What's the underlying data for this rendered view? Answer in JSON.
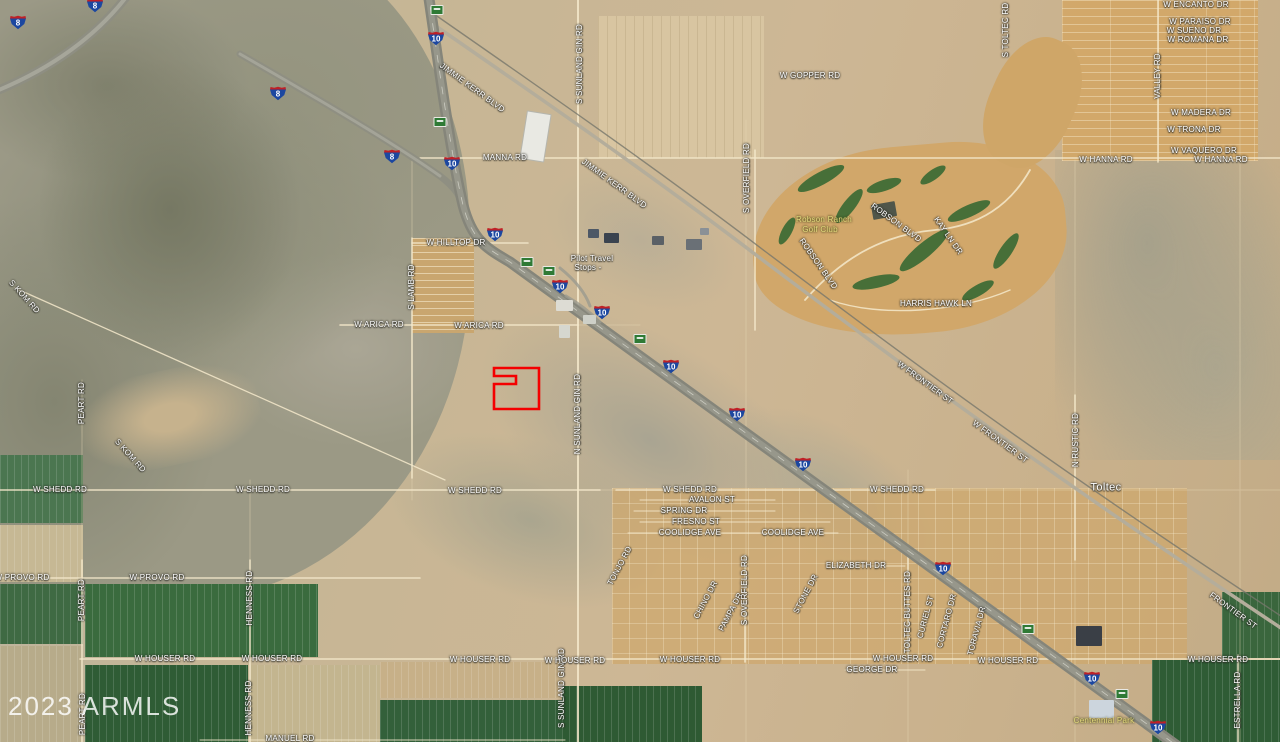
{
  "watermark": {
    "text": "2023 ARMLS"
  },
  "colors": {
    "parcel_outline": "#f40000",
    "shield_blue": "#1c47a0",
    "shield_red": "#bf2026",
    "mile_marker_green": "#2f7a35"
  },
  "map": {
    "parcel": {
      "x": 494,
      "y": 368,
      "w": 45,
      "h": 41,
      "notch_x": 516,
      "notch_y1": 376,
      "notch_y2": 384,
      "stroke": "#f40000",
      "stroke_width": 2.6
    },
    "labels": [
      {
        "t": "JIMMIE KERR BLVD",
        "x": 472,
        "y": 88,
        "r": 36
      },
      {
        "t": "JIMMIE KERR BLVD",
        "x": 614,
        "y": 184,
        "r": 36
      },
      {
        "t": "MANNA RD",
        "x": 505,
        "y": 158
      },
      {
        "t": "W GOPPER RD",
        "x": 810,
        "y": 76
      },
      {
        "t": "S TOLTEC RD",
        "x": 1006,
        "y": 30,
        "r": -90
      },
      {
        "t": "W ENCANTO DR",
        "x": 1196,
        "y": 5
      },
      {
        "t": "W PARAISO DR",
        "x": 1200,
        "y": 22
      },
      {
        "t": "W SUENO DR",
        "x": 1194,
        "y": 31
      },
      {
        "t": "W ROMANA DR",
        "x": 1198,
        "y": 40
      },
      {
        "t": "VALLEY RD",
        "x": 1158,
        "y": 76,
        "r": -90
      },
      {
        "t": "W MADERA DR",
        "x": 1201,
        "y": 113
      },
      {
        "t": "W TRONA DR",
        "x": 1194,
        "y": 130
      },
      {
        "t": "W VAQUERO DR",
        "x": 1204,
        "y": 151
      },
      {
        "t": "W HANNA RD",
        "x": 1106,
        "y": 160
      },
      {
        "t": "W HANNA RD",
        "x": 1221,
        "y": 160
      },
      {
        "t": "S SUNLAND GIN RD",
        "x": 580,
        "y": 64,
        "r": -90
      },
      {
        "t": "W HILLTOP DR",
        "x": 456,
        "y": 243
      },
      {
        "t": "S LAMB RD",
        "x": 412,
        "y": 287,
        "r": -90
      },
      {
        "t": "W ARICA RD",
        "x": 379,
        "y": 325
      },
      {
        "t": "W ARICA RD",
        "x": 479,
        "y": 326
      },
      {
        "t": "S OVERFIELD RD",
        "x": 747,
        "y": 178,
        "r": -90
      },
      {
        "t": "ROBSON BLVD",
        "x": 896,
        "y": 223,
        "r": 36
      },
      {
        "t": "ROBSON BLVD",
        "x": 818,
        "y": 264,
        "r": 55
      },
      {
        "t": "KAY LN DR",
        "x": 948,
        "y": 236,
        "r": 55
      },
      {
        "t": "HARRIS HAWK LN",
        "x": 936,
        "y": 304
      },
      {
        "t": "N SUNLAND GIN RD",
        "x": 578,
        "y": 414,
        "r": -90
      },
      {
        "t": "W FRONTIER ST",
        "x": 925,
        "y": 383,
        "r": 36
      },
      {
        "t": "W FRONTIER ST",
        "x": 1000,
        "y": 442,
        "r": 36
      },
      {
        "t": "N RUSTIC RD",
        "x": 1076,
        "y": 440,
        "r": -90
      },
      {
        "t": "S KOM RD",
        "x": 24,
        "y": 297,
        "r": 48
      },
      {
        "t": "S KOM RD",
        "x": 130,
        "y": 456,
        "r": 48
      },
      {
        "t": "PEART RD",
        "x": 82,
        "y": 403,
        "r": -90
      },
      {
        "t": "W SHEDD RD",
        "x": 60,
        "y": 490
      },
      {
        "t": "W SHEDD RD",
        "x": 263,
        "y": 490
      },
      {
        "t": "W SHEDD RD",
        "x": 475,
        "y": 491
      },
      {
        "t": "W SHEDD RD",
        "x": 690,
        "y": 490
      },
      {
        "t": "W SHEDD RD",
        "x": 897,
        "y": 490
      },
      {
        "t": "AVALON ST",
        "x": 712,
        "y": 500
      },
      {
        "t": "SPRING DR",
        "x": 684,
        "y": 511
      },
      {
        "t": "FRESNO ST",
        "x": 696,
        "y": 522
      },
      {
        "t": "COOLIDGE AVE",
        "x": 690,
        "y": 533
      },
      {
        "t": "COOLIDGE AVE",
        "x": 793,
        "y": 533
      },
      {
        "t": "W PROVO RD",
        "x": 22,
        "y": 578
      },
      {
        "t": "W PROVO RD",
        "x": 157,
        "y": 578
      },
      {
        "t": "PEART RD",
        "x": 82,
        "y": 600,
        "r": -90
      },
      {
        "t": "HENNESS RD",
        "x": 250,
        "y": 598,
        "r": -90
      },
      {
        "t": "TONJO RD",
        "x": 620,
        "y": 566,
        "r": -62
      },
      {
        "t": "ELIZABETH DR",
        "x": 856,
        "y": 566
      },
      {
        "t": "CHINO DR",
        "x": 706,
        "y": 600,
        "r": -62
      },
      {
        "t": "PAMPA DR",
        "x": 731,
        "y": 612,
        "r": -62
      },
      {
        "t": "STONE DR",
        "x": 806,
        "y": 594,
        "r": -62
      },
      {
        "t": "S OVERFIELD RD",
        "x": 745,
        "y": 590,
        "r": -90
      },
      {
        "t": "S SUNLAND GIN RD",
        "x": 562,
        "y": 688,
        "r": -90
      },
      {
        "t": "TOLTEC BUTTES RD",
        "x": 908,
        "y": 612,
        "r": -90
      },
      {
        "t": "CURIEL ST",
        "x": 926,
        "y": 617,
        "r": -75
      },
      {
        "t": "CORTARO DR",
        "x": 947,
        "y": 621,
        "r": -75
      },
      {
        "t": "TORAVIA DR",
        "x": 977,
        "y": 631,
        "r": -75
      },
      {
        "t": "FRONTIER ST",
        "x": 1233,
        "y": 611,
        "r": 36
      },
      {
        "t": "ESTRELLA RD",
        "x": 1238,
        "y": 700,
        "r": -90
      },
      {
        "t": "W HOUSER RD",
        "x": 165,
        "y": 659
      },
      {
        "t": "W HOUSER RD",
        "x": 272,
        "y": 659
      },
      {
        "t": "W HOUSER RD",
        "x": 480,
        "y": 660
      },
      {
        "t": "W HOUSER RD",
        "x": 575,
        "y": 661
      },
      {
        "t": "W HOUSER RD",
        "x": 690,
        "y": 660
      },
      {
        "t": "W HOUSER RD",
        "x": 903,
        "y": 659
      },
      {
        "t": "W HOUSER RD",
        "x": 1008,
        "y": 661
      },
      {
        "t": "W HOUSER RD",
        "x": 1218,
        "y": 660
      },
      {
        "t": "GEORGE DR",
        "x": 872,
        "y": 670
      },
      {
        "t": "HENNESS RD",
        "x": 249,
        "y": 708,
        "r": -90
      },
      {
        "t": "PEART RD",
        "x": 83,
        "y": 714,
        "r": -90
      },
      {
        "t": "MANUEL RD",
        "x": 290,
        "y": 739
      },
      {
        "t": "Toltec",
        "x": 1106,
        "y": 488,
        "c": "place",
        "n": "place-label"
      },
      {
        "t": "Pilot Travel",
        "x": 592,
        "y": 259,
        "c": "poi",
        "n": "poi-label"
      },
      {
        "t": "Stops -",
        "x": 588,
        "y": 268,
        "c": "poi",
        "n": "poi-label"
      },
      {
        "t": "Robson Ranch",
        "x": 824,
        "y": 220,
        "c": "park",
        "n": "park-label"
      },
      {
        "t": "Golf Club",
        "x": 820,
        "y": 230,
        "c": "park",
        "n": "park-label"
      },
      {
        "t": "Centennial Park",
        "x": 1104,
        "y": 721,
        "c": "park",
        "n": "park-label"
      }
    ],
    "shields": [
      {
        "number": "8",
        "x": 18,
        "y": 22
      },
      {
        "number": "8",
        "x": 95,
        "y": 5
      },
      {
        "number": "8",
        "x": 278,
        "y": 93
      },
      {
        "number": "8",
        "x": 392,
        "y": 156
      },
      {
        "number": "10",
        "x": 436,
        "y": 38
      },
      {
        "number": "10",
        "x": 452,
        "y": 163
      },
      {
        "number": "10",
        "x": 495,
        "y": 234
      },
      {
        "number": "10",
        "x": 560,
        "y": 286
      },
      {
        "number": "10",
        "x": 602,
        "y": 312
      },
      {
        "number": "10",
        "x": 671,
        "y": 366
      },
      {
        "number": "10",
        "x": 737,
        "y": 414
      },
      {
        "number": "10",
        "x": 803,
        "y": 464
      },
      {
        "number": "10",
        "x": 943,
        "y": 568
      },
      {
        "number": "10",
        "x": 1092,
        "y": 678
      },
      {
        "number": "10",
        "x": 1158,
        "y": 727
      }
    ],
    "mile_markers": [
      {
        "x": 437,
        "y": 10
      },
      {
        "x": 440,
        "y": 122
      },
      {
        "x": 527,
        "y": 262
      },
      {
        "x": 549,
        "y": 271
      },
      {
        "x": 640,
        "y": 339
      },
      {
        "x": 1028,
        "y": 629
      },
      {
        "x": 1122,
        "y": 694
      }
    ]
  }
}
